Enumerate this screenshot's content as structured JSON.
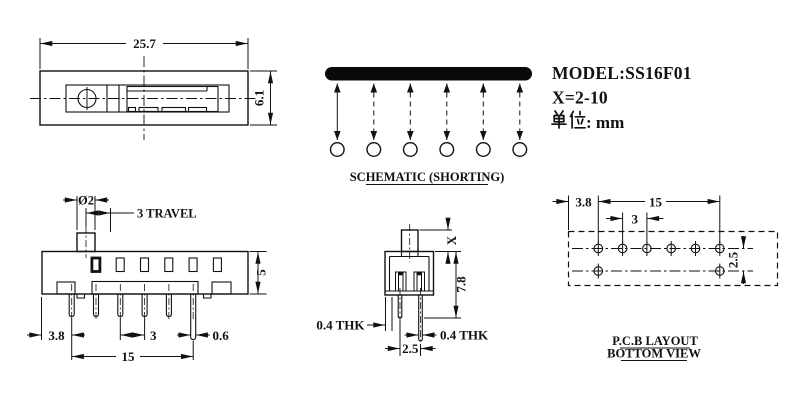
{
  "title_block": {
    "model": "MODEL:SS16F01",
    "x_range": "X=2-10",
    "unit_full": "单位: mm",
    "unit_cjk": "单位",
    "unit_rest": ": mm"
  },
  "top_view": {
    "dim_width": "25.7",
    "dim_height": "6.1"
  },
  "schematic": {
    "label": "SCHEMATIC (SHORTING)",
    "positions": 6,
    "bar_color": "#0a0a0a"
  },
  "front_view": {
    "knob_dia": "Ø2",
    "travel": "3 TRAVEL",
    "body_height": "5",
    "left_offset": "3.8",
    "pitch": "3",
    "span": "15",
    "pin_width": "0.6",
    "pins": 6
  },
  "side_view": {
    "knob_height": "X",
    "total_height": "7.8",
    "thk_left": "0.4 THK",
    "thk_right": "0.4 THK",
    "pin_spacing": "2.5"
  },
  "pcb_view": {
    "label1": "P.C.B LAYOUT",
    "label2": "BOTTOM VIEW",
    "left_offset": "3.8",
    "span": "15",
    "pitch": "3",
    "row_spacing": "2.5",
    "holes_top": 6,
    "holes_bottom": 2
  },
  "colors": {
    "line": "#111111",
    "background": "#ffffff"
  }
}
